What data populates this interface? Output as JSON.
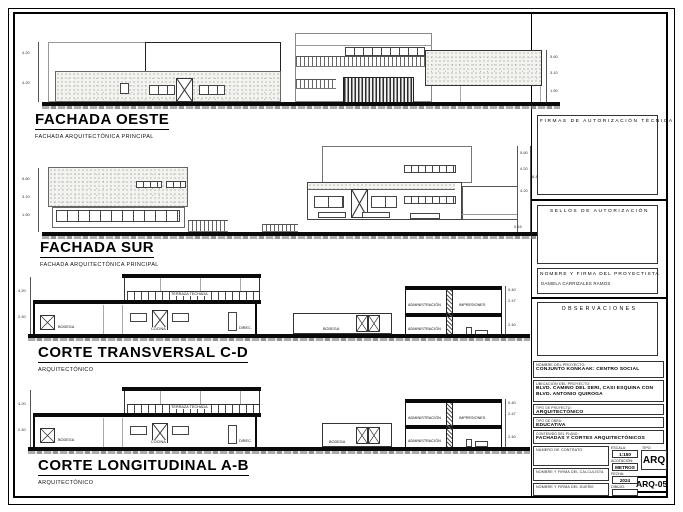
{
  "drawings": {
    "oeste": {
      "title": "FACHADA OESTE",
      "subtitle": "FACHADA ARQUITECTÓNICA PRINCIPAL",
      "dims_left": [
        "4.20",
        "4.20"
      ],
      "dims_right": [
        "5.60",
        "3.10",
        "1.50"
      ]
    },
    "sur": {
      "title": "FACHADA SUR",
      "subtitle": "FACHADA ARQUITECTÓNICA PRINCIPAL",
      "dims_left": [
        "5.60",
        "3.10",
        "1.50"
      ],
      "dims_right": [
        "5.60",
        "4.20",
        "8.40",
        "4.20",
        "0.15"
      ]
    },
    "transversal": {
      "title": "CORTE TRANSVERSAL C-D",
      "subtitle": "ARQUITECTÓNICO",
      "dims_left": [
        "4.20",
        "2.40"
      ],
      "dims_right": [
        "0.40",
        "2.47",
        "2.40"
      ],
      "rooms": {
        "terraza": "TERRAZA TECHADA",
        "bodega": "BODEGA",
        "cocina": "COCINA",
        "direc": "DIREC.",
        "bodega_patio": "BODEGA",
        "admin_sup": "ADMINISTRACIÓN",
        "impresiones": "IMPRESIONES",
        "admin_inf": "ADMINISTRACIÓN"
      }
    },
    "longitudinal": {
      "title": "CORTE LONGITUDINAL A-B",
      "subtitle": "ARQUITECTÓNICO",
      "dims_left": [
        "4.20",
        "2.40"
      ],
      "dims_right": [
        "0.40",
        "2.47",
        "2.40"
      ],
      "rooms": {
        "terraza": "TERRAZA TECHADA",
        "bodega": "BODEGA",
        "cocina": "COCINA",
        "direc": "DIREC.",
        "bodega_patio": "BODEGA",
        "admin_sup": "ADMINISTRACIÓN",
        "impresiones": "IMPRESIONES",
        "admin_inf": "ADMINISTRACIÓN"
      }
    }
  },
  "titleblock": {
    "firmas_label": "FIRMAS DE AUTORIZACIÓN TÉCNICA",
    "sellos_label": "SELLOS DE AUTORIZACIÓN",
    "proyectista_label": "NOMBRE Y FIRMA DEL PROYECTISTA",
    "proyectista_value": "DANIELA CARRIZALES RAMOS",
    "observaciones_label": "OBSERVACIONES",
    "nombre_label": "NOMBRE DEL PROYECTO:",
    "nombre_value": "CONJUNTO KONKAAK: CENTRO SOCIAL",
    "ubicacion_label": "UBICACIÓN DEL PROYECTO:",
    "ubicacion_value": "BLVD. CAMINO DEL SERI, CASI ESQUINA CON BLVD. ANTONIO QUIROGA",
    "tipo_proyecto_label": "TIPO DE PROYECTO:",
    "tipo_proyecto_value": "ARQUITECTÓNICO",
    "tipo_obra_label": "TIPO DE OBRA:",
    "tipo_obra_value": "EDUCATIVA",
    "contenido_label": "CONTENIDO DEL PLANO:",
    "contenido_value": "FACHADAS Y CORTES ARQUITECTÓNICOS",
    "contrato_label": "NÚMERO DE CONTRATO",
    "calculista_label": "NOMBRE Y FIRMA DEL CALCULISTA",
    "dueno_label": "NOMBRE Y FIRMA DEL DUEÑO",
    "escala_label": "ESCALA:",
    "escala_value": "1:150",
    "acotacion_label": "ACOTACIÓN:",
    "acotacion_value": "METROS",
    "fecha_label": "FECHA:",
    "fecha_value": "2024",
    "dibujo_label": "DIBUJO:",
    "tipo_label": "TIPO:",
    "tipo_value": "ARQ",
    "sheet_number": "ARQ-05"
  },
  "colors": {
    "ink": "#0a0a0a",
    "paper": "#ffffff",
    "stipple": "#7d7d7d"
  }
}
